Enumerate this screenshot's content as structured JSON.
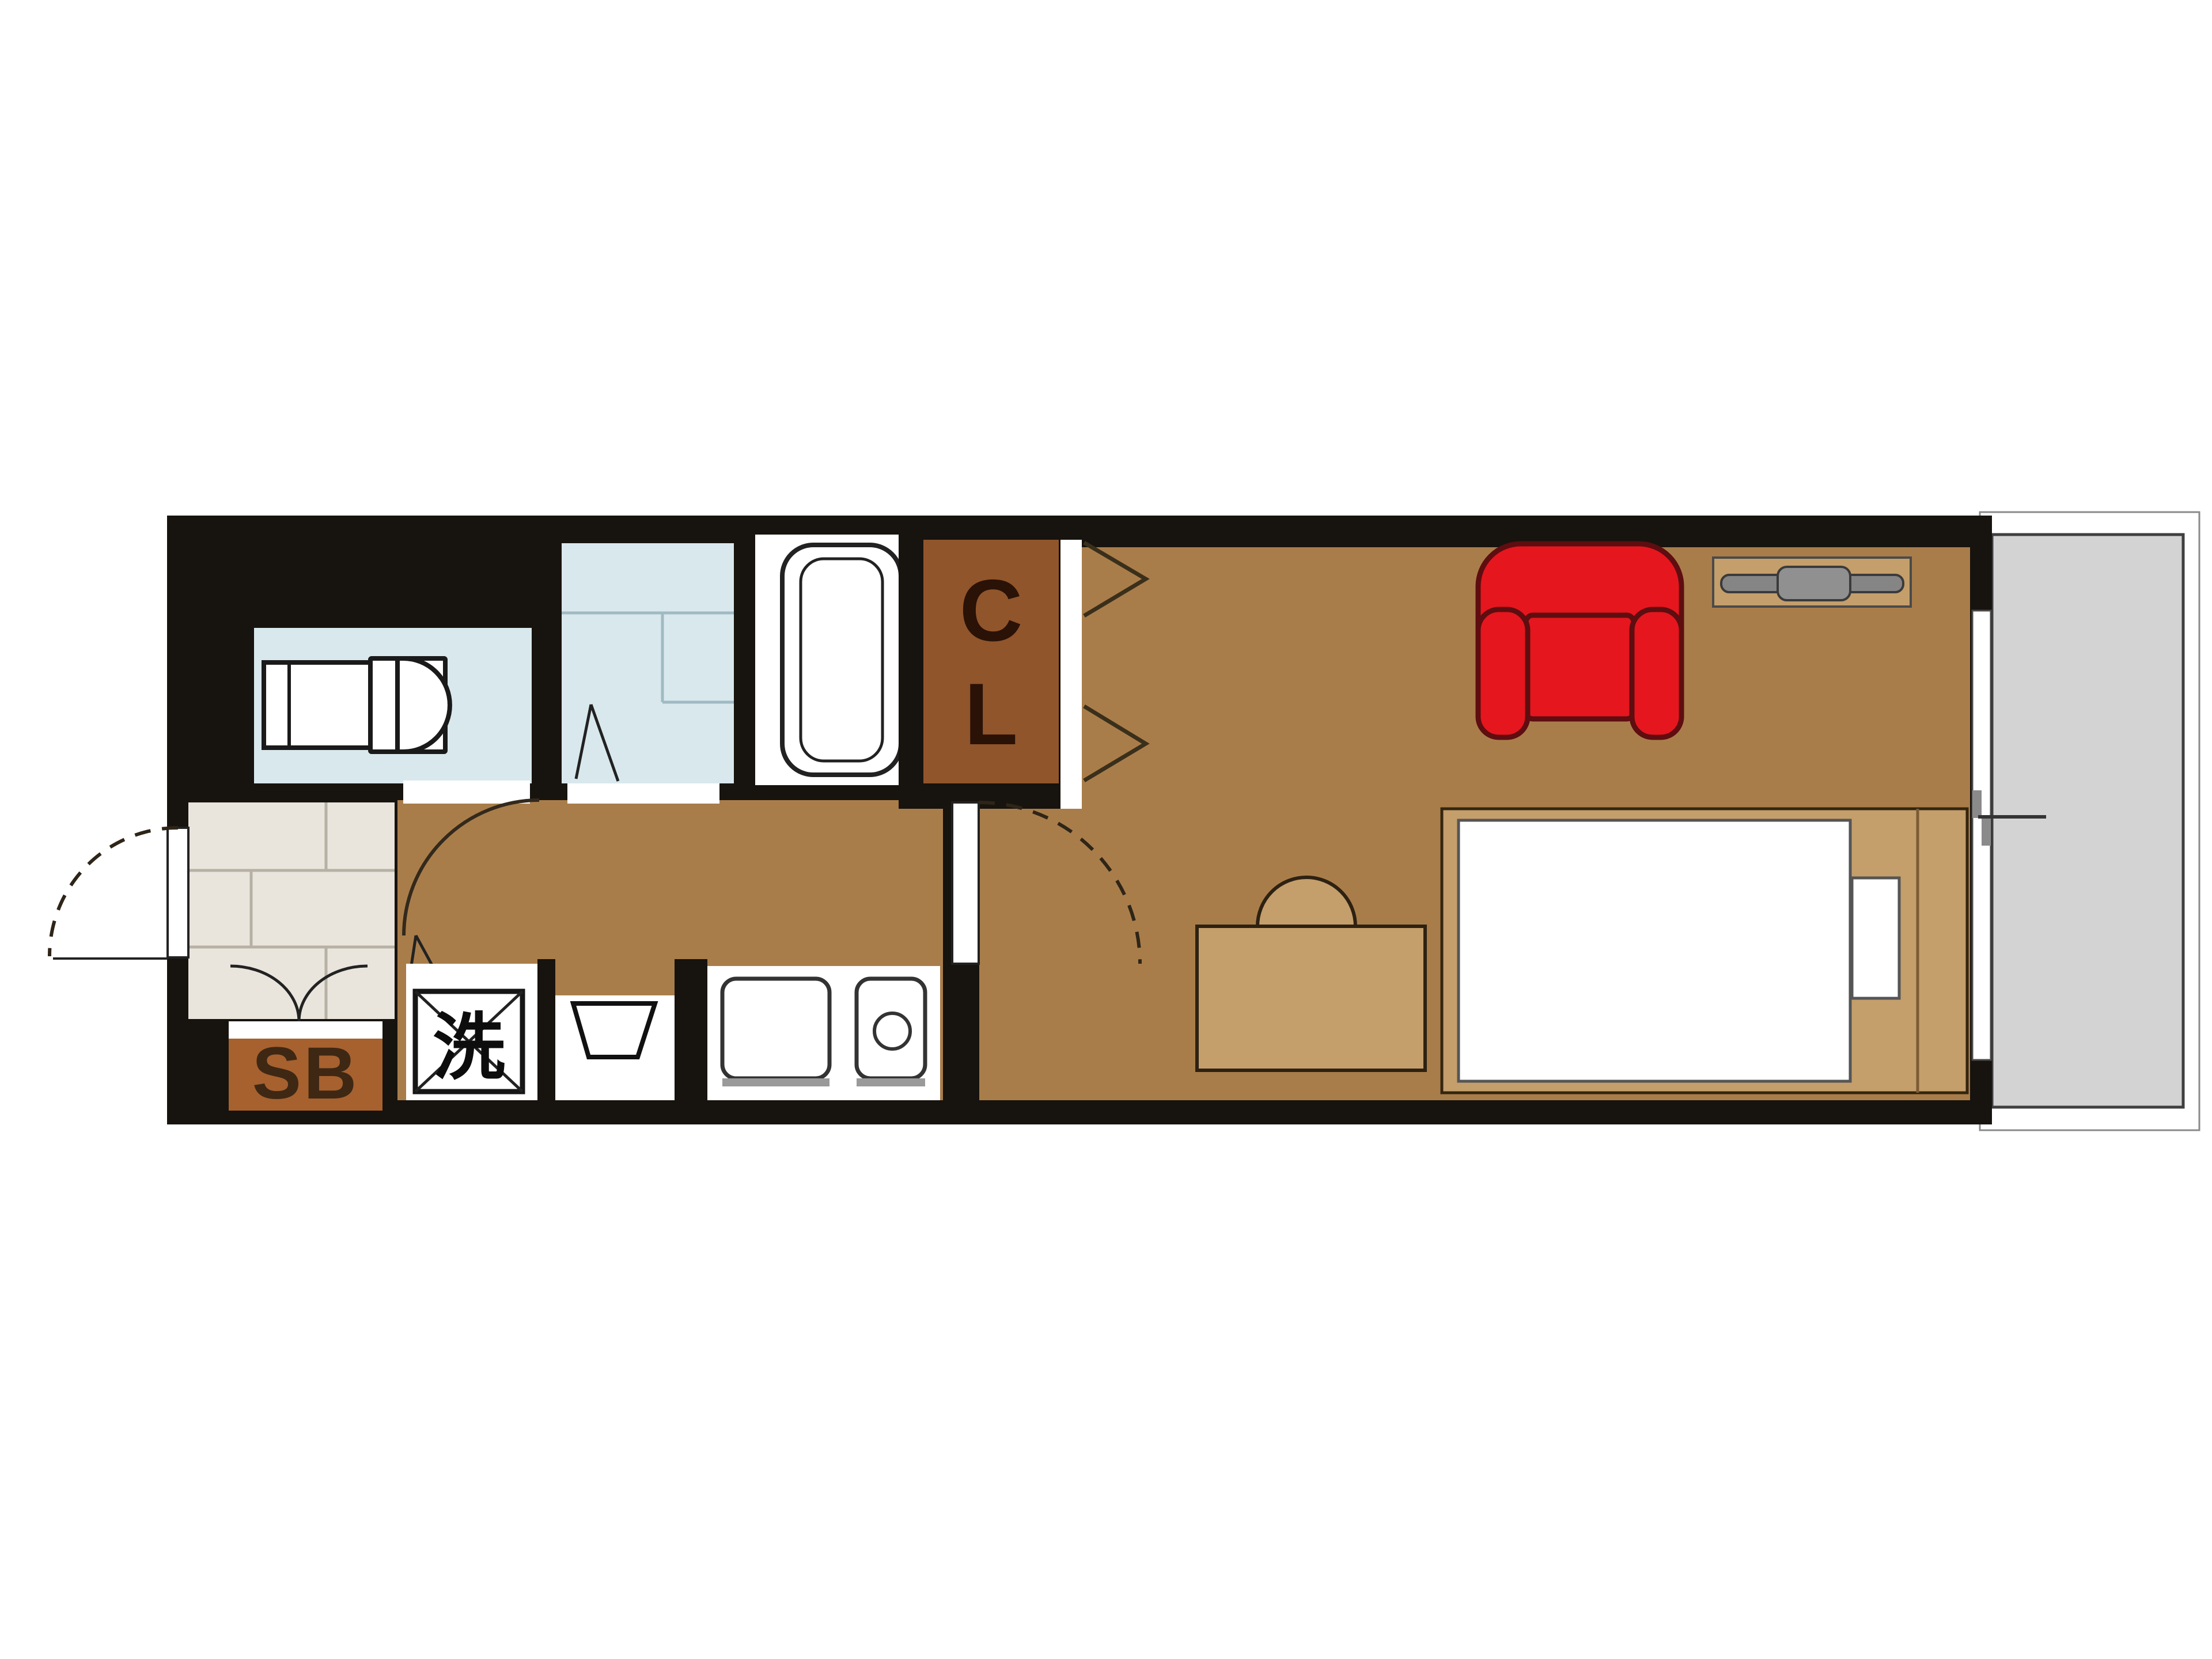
{
  "plan": {
    "labels": {
      "closet": "CL",
      "laundry": "洗",
      "shoe_box": "SB"
    },
    "colors": {
      "wall": "#17130E",
      "living_floor": "#A97D4A",
      "wet_floor": "#D9E8ED",
      "tile_floor": "#E9E5DC",
      "closet_floor": "#91552B",
      "shoe_box": "#A6612F",
      "balcony_floor": "#D3D3D3",
      "sofa": "#E6161E",
      "furniture_wood": "#C49E6B",
      "fixture_white": "#FFFFFF",
      "tv_gray": "#858585"
    }
  }
}
